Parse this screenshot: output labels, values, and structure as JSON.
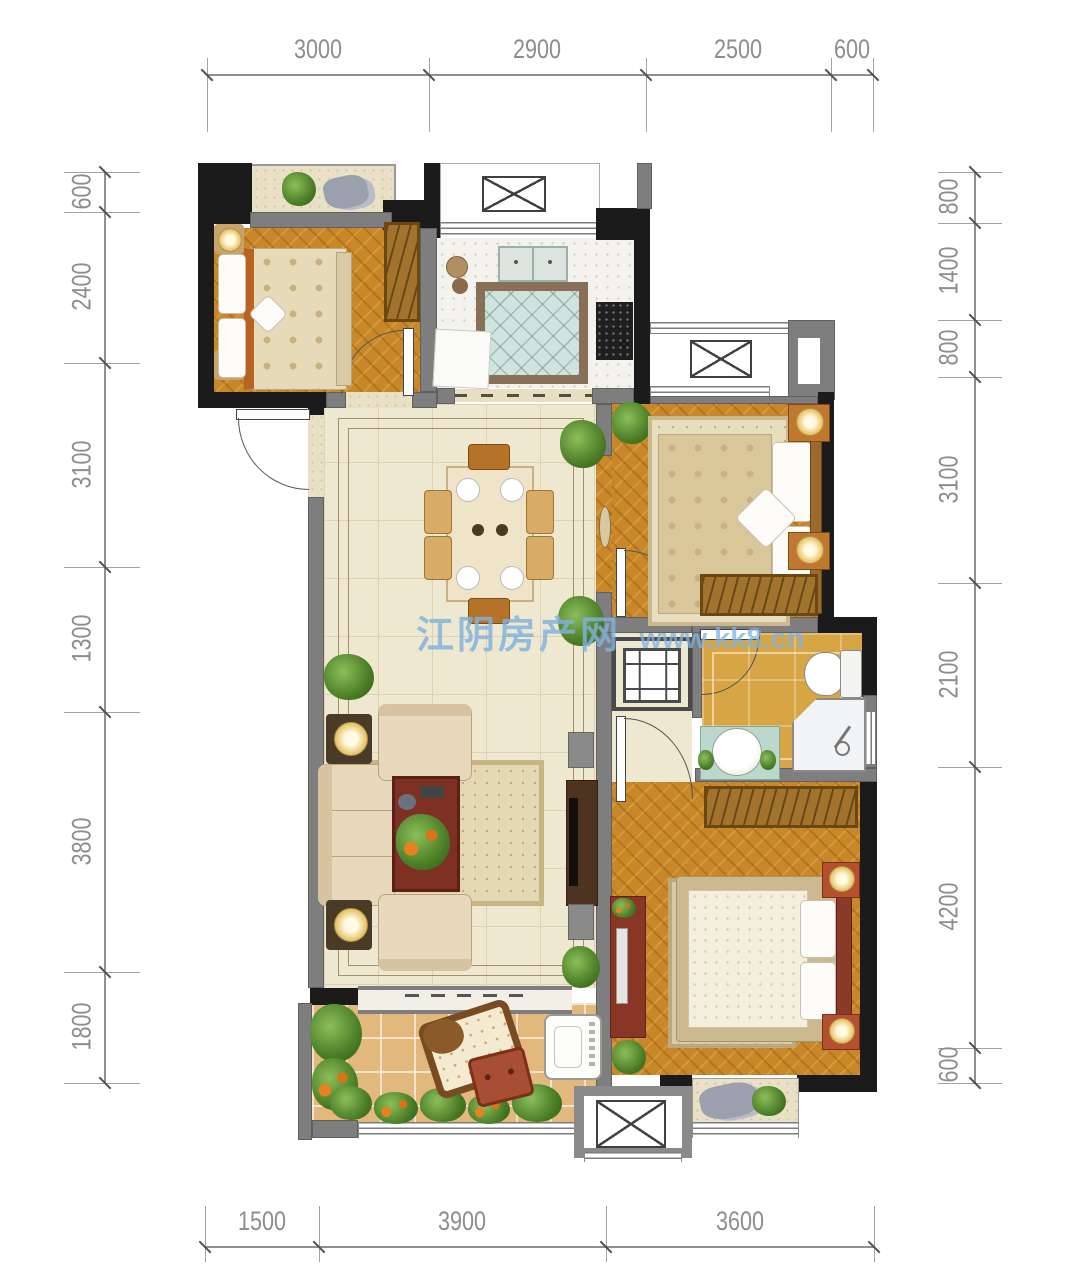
{
  "watermark": {
    "site_name": "江阴房产网",
    "site_url": "www.kk8.cn"
  },
  "dimensions": {
    "top": {
      "labels": [
        "3000",
        "2900",
        "2500",
        "600"
      ]
    },
    "bottom": {
      "labels": [
        "1500",
        "3900",
        "3600"
      ]
    },
    "left": {
      "labels": [
        "600",
        "2400",
        "3100",
        "1300",
        "3800",
        "1800"
      ]
    },
    "right": {
      "labels": [
        "800",
        "1400",
        "800",
        "3100",
        "2100",
        "4200",
        "600"
      ]
    }
  },
  "palette": {
    "wall_black": "#1b1b1b",
    "wall_gray": "#7e7e7e",
    "wood_floor": "#c8882a",
    "tile_floor": "#efe8d0",
    "kitchen_floor": "#f4f2ec",
    "bath_floor": "#d7a544",
    "balcony_floor": "#e3b87d",
    "dimension_text": "#8d8d8d",
    "watermark_blue": "#7fb2de"
  }
}
